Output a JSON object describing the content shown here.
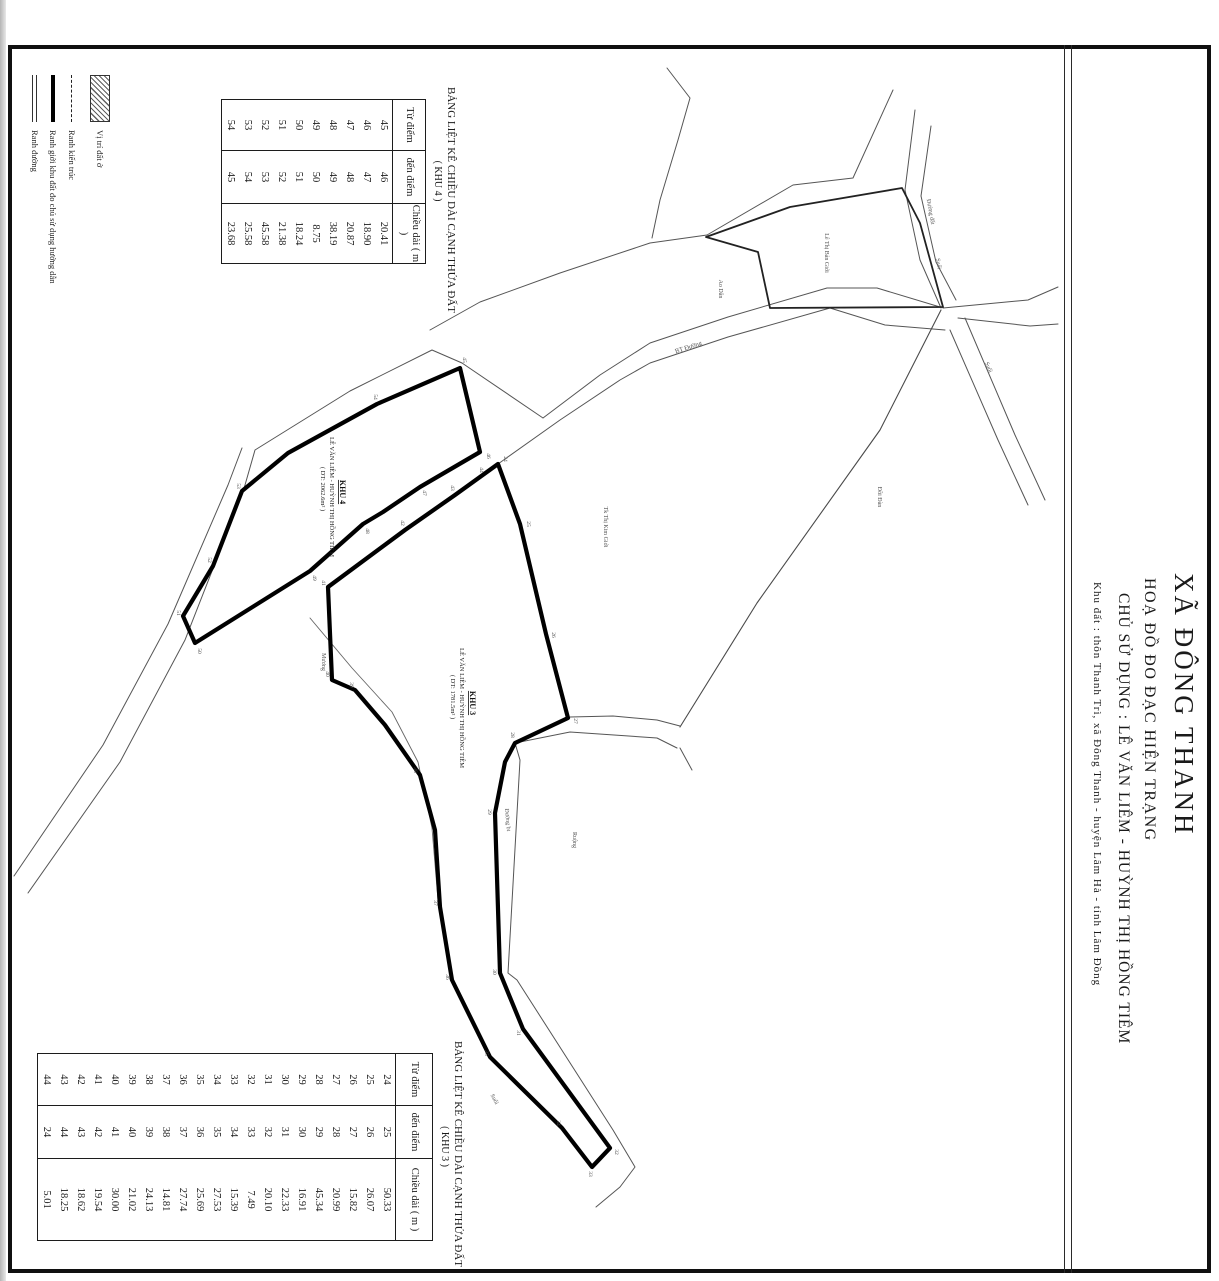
{
  "title_block": {
    "line1": "XÃ ĐÔNG THANH",
    "line2": "HOẠ ĐỒ ĐO ĐẠC HIỆN TRẠNG",
    "line3": "CHỦ SỬ DỤNG : LÊ VĂN LIÊM - HUỲNH THỊ HỒNG TIÊM",
    "line4": "Khu đất : thôn Thanh Trì, xã Đông Thanh - huyện Lâm Hà - tỉnh Lâm Đồng"
  },
  "legend": {
    "items": [
      {
        "symbol": "hatch",
        "label": "Vị trí đất ở"
      },
      {
        "symbol": "dashed",
        "label": "Ranh kiến trúc"
      },
      {
        "symbol": "thick",
        "label": "Ranh giới khu đất đo chủ sử dụng hướng dẫn"
      },
      {
        "symbol": "double",
        "label": "Ranh đường"
      }
    ]
  },
  "tables": [
    {
      "id": "khu4",
      "title": "BẢNG LIỆT KÊ CHIỀU DÀI CẠNH THỬA ĐẤT",
      "subtitle": "( KHU 4 )",
      "columns": [
        "Từ điểm",
        "đến điểm",
        "Chiều dài ( m )"
      ],
      "rows": [
        [
          "45",
          "46",
          "20.41"
        ],
        [
          "46",
          "47",
          "18.90"
        ],
        [
          "47",
          "48",
          "20.87"
        ],
        [
          "48",
          "49",
          "38.19"
        ],
        [
          "49",
          "50",
          "8.75"
        ],
        [
          "50",
          "51",
          "18.24"
        ],
        [
          "51",
          "52",
          "21.38"
        ],
        [
          "52",
          "53",
          "45.58"
        ],
        [
          "53",
          "54",
          "25.58"
        ],
        [
          "54",
          "45",
          "23.68"
        ]
      ]
    },
    {
      "id": "khu3",
      "title": "BẢNG LIỆT KÊ CHIỀU DÀI CẠNH THỬA ĐẤT",
      "subtitle": "( KHU 3 )",
      "columns": [
        "Từ điểm",
        "đến điểm",
        "Chiều dài ( m )"
      ],
      "rows": [
        [
          "24",
          "25",
          "50.33"
        ],
        [
          "25",
          "26",
          "26.07"
        ],
        [
          "26",
          "27",
          "15.82"
        ],
        [
          "27",
          "28",
          "20.99"
        ],
        [
          "28",
          "29",
          "45.34"
        ],
        [
          "29",
          "30",
          "16.91"
        ],
        [
          "30",
          "31",
          "22.33"
        ],
        [
          "31",
          "32",
          "20.10"
        ],
        [
          "32",
          "33",
          "7.49"
        ],
        [
          "33",
          "34",
          "15.39"
        ],
        [
          "34",
          "35",
          "27.53"
        ],
        [
          "35",
          "36",
          "25.69"
        ],
        [
          "36",
          "37",
          "27.74"
        ],
        [
          "37",
          "38",
          "14.81"
        ],
        [
          "38",
          "39",
          "24.13"
        ],
        [
          "39",
          "40",
          "21.02"
        ],
        [
          "40",
          "41",
          "30.00"
        ],
        [
          "41",
          "42",
          "19.54"
        ],
        [
          "42",
          "43",
          "18.62"
        ],
        [
          "43",
          "44",
          "18.25"
        ],
        [
          "44",
          "24",
          "5.01"
        ]
      ]
    }
  ],
  "map": {
    "labels": [
      {
        "name": "parcel-khu4-title",
        "text": "KHU 4",
        "x": 340,
        "y": 492,
        "rot": 90,
        "size": 8,
        "bold": true,
        "underline": true,
        "color": "#111"
      },
      {
        "name": "parcel-khu4-owner",
        "text": "LÊ VĂN LIÊM - HUỲNH THỊ HỒNG TIÊM",
        "x": 330,
        "y": 497,
        "rot": 90,
        "size": 6.5,
        "color": "#222"
      },
      {
        "name": "parcel-khu4-area",
        "text": "( DT: 2062.6m² )",
        "x": 321,
        "y": 489,
        "rot": 90,
        "size": 6.5,
        "color": "#222"
      },
      {
        "name": "parcel-khu3-title",
        "text": "KHU 3",
        "x": 470,
        "y": 703,
        "rot": 90,
        "size": 8,
        "bold": true,
        "underline": true,
        "color": "#111"
      },
      {
        "name": "parcel-khu3-owner",
        "text": "LÊ VĂN LIÊM - HUỲNH THỊ HỒNG TIÊM",
        "x": 460,
        "y": 708,
        "rot": 90,
        "size": 6.5,
        "color": "#222"
      },
      {
        "name": "parcel-khu3-area",
        "text": "( DT: 1781.5m² )",
        "x": 451,
        "y": 697,
        "rot": 90,
        "size": 6.5,
        "color": "#222"
      },
      {
        "name": "neighbor-label",
        "text": "Tk Thị Kim Giới",
        "x": 604,
        "y": 527,
        "rot": 90,
        "size": 6,
        "color": "#555"
      },
      {
        "name": "hill-label",
        "text": "Đồi Đàn",
        "x": 878,
        "y": 497,
        "rot": 90,
        "size": 6,
        "color": "#555"
      },
      {
        "name": "road-label-bt-duong",
        "text": "BT Đường",
        "x": 689,
        "y": 349,
        "rot": -18,
        "size": 6.5,
        "color": "#555"
      },
      {
        "name": "road-label-duong-dat",
        "text": "Đường đất",
        "x": 929,
        "y": 212,
        "rot": 80,
        "size": 6,
        "color": "#555"
      },
      {
        "name": "stream-label-suoi-1",
        "text": "Suối",
        "x": 937,
        "y": 264,
        "rot": 80,
        "size": 6,
        "color": "#555"
      },
      {
        "name": "stream-label-suoi-2",
        "text": "Suối",
        "x": 987,
        "y": 368,
        "rot": 67,
        "size": 6,
        "color": "#555"
      },
      {
        "name": "pond-label",
        "text": "Ao Dân",
        "x": 719,
        "y": 289,
        "rot": 90,
        "size": 6,
        "color": "#555"
      },
      {
        "name": "neighbor-parcel-label",
        "text": "Lê Thị Bản Giới",
        "x": 825,
        "y": 253,
        "rot": 90,
        "size": 6,
        "color": "#555"
      },
      {
        "name": "canal-label",
        "text": "Mương",
        "x": 322,
        "y": 662,
        "rot": 90,
        "size": 6,
        "color": "#555"
      },
      {
        "name": "field-label",
        "text": "Ruộng",
        "x": 573,
        "y": 840,
        "rot": 90,
        "size": 6,
        "color": "#555"
      },
      {
        "name": "path-label",
        "text": "Đường bt",
        "x": 506,
        "y": 820,
        "rot": 85,
        "size": 6,
        "color": "#555"
      },
      {
        "name": "stream-label-suoi-3",
        "text": "Suối",
        "x": 493,
        "y": 1100,
        "rot": 62,
        "size": 6,
        "color": "#555"
      }
    ],
    "point_labels": [
      {
        "n": "45",
        "x": 463,
        "y": 360
      },
      {
        "n": "46",
        "x": 487,
        "y": 456
      },
      {
        "n": "47",
        "x": 423,
        "y": 493
      },
      {
        "n": "48",
        "x": 366,
        "y": 531
      },
      {
        "n": "49",
        "x": 313,
        "y": 578
      },
      {
        "n": "50",
        "x": 198,
        "y": 651
      },
      {
        "n": "51",
        "x": 177,
        "y": 613
      },
      {
        "n": "52",
        "x": 208,
        "y": 560
      },
      {
        "n": "53",
        "x": 237,
        "y": 486
      },
      {
        "n": "54",
        "x": 374,
        "y": 397
      },
      {
        "n": "24",
        "x": 504,
        "y": 459
      },
      {
        "n": "25",
        "x": 527,
        "y": 524
      },
      {
        "n": "26",
        "x": 552,
        "y": 635
      },
      {
        "n": "27",
        "x": 574,
        "y": 721
      },
      {
        "n": "28",
        "x": 511,
        "y": 735
      },
      {
        "n": "29",
        "x": 488,
        "y": 812
      },
      {
        "n": "30",
        "x": 493,
        "y": 972
      },
      {
        "n": "31",
        "x": 517,
        "y": 1033
      },
      {
        "n": "32",
        "x": 615,
        "y": 1152
      },
      {
        "n": "33",
        "x": 589,
        "y": 1174
      },
      {
        "n": "34",
        "x": 557,
        "y": 1123
      },
      {
        "n": "35",
        "x": 485,
        "y": 1053
      },
      {
        "n": "36",
        "x": 446,
        "y": 977
      },
      {
        "n": "37",
        "x": 434,
        "y": 903
      },
      {
        "n": "38",
        "x": 414,
        "y": 770
      },
      {
        "n": "39",
        "x": 350,
        "y": 685
      },
      {
        "n": "40",
        "x": 326,
        "y": 674
      },
      {
        "n": "41",
        "x": 322,
        "y": 583
      },
      {
        "n": "42",
        "x": 401,
        "y": 523
      },
      {
        "n": "43",
        "x": 451,
        "y": 488
      },
      {
        "n": "44",
        "x": 480,
        "y": 470
      }
    ]
  }
}
